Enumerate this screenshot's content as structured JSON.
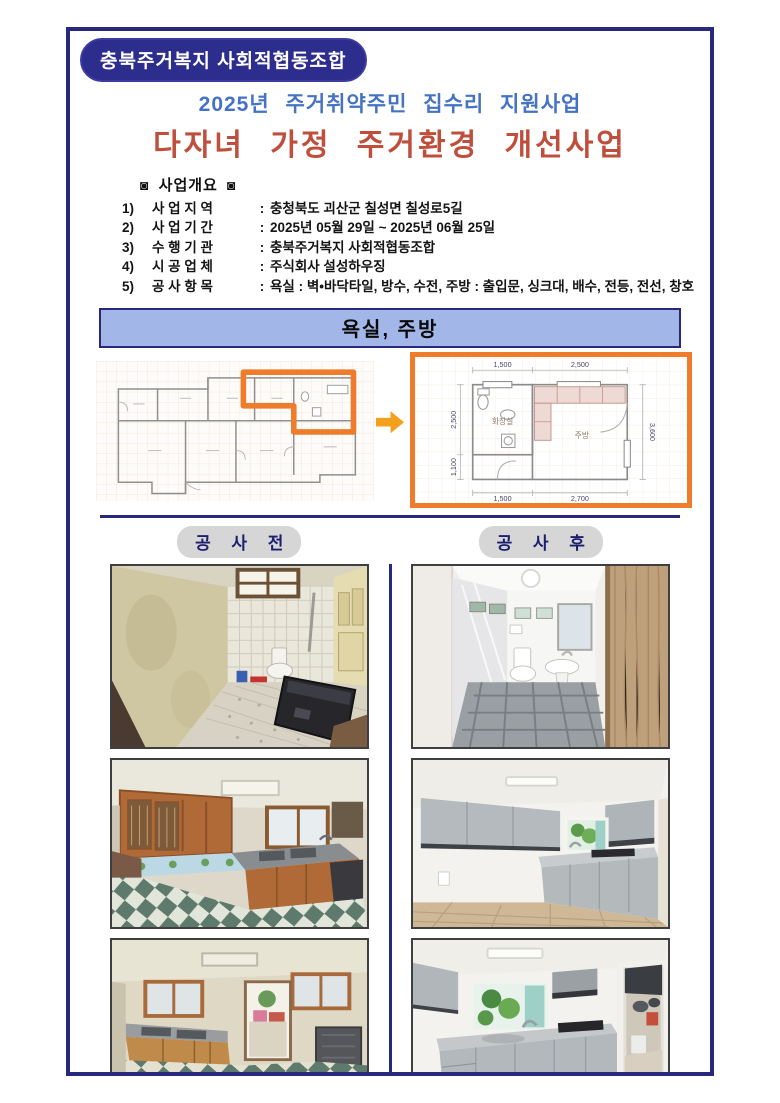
{
  "header": {
    "org_badge": "충북주거복지 사회적협동조합",
    "subtitle": "2025년 주거취약주민 집수리 지원사업",
    "title": "다자녀 가정 주거환경 개선사업"
  },
  "overview": {
    "symbol": "◙",
    "heading": "사업개요",
    "items": [
      {
        "num": "1)",
        "label": "사 업 지 역",
        "colon": ":",
        "value": "충청북도 괴산군 칠성면 칠성로5길"
      },
      {
        "num": "2)",
        "label": "사 업 기 간",
        "colon": ":",
        "value": "2025년 05월 29일 ~ 2025년 06월 25일"
      },
      {
        "num": "3)",
        "label": "수 행 기 관",
        "colon": ":",
        "value": "충북주거복지 사회적협동조합"
      },
      {
        "num": "4)",
        "label": "시 공 업 체",
        "colon": ":",
        "value": "주식회사 설성하우징"
      },
      {
        "num": "5)",
        "label": "공 사 항 목",
        "colon": ":",
        "value": "욕실 : 벽•바닥타일, 방수, 수전,  주방 : 출입문, 싱크대, 배수, 전등, 전선, 창호"
      }
    ]
  },
  "banner": {
    "label": "욕실, 주방"
  },
  "floorplan": {
    "detail": {
      "room_bathroom": "화장실",
      "room_kitchen": "주방",
      "dims": {
        "top_left": "1,500",
        "top_right": "2,500",
        "bottom_left": "1,500",
        "bottom_right": "2,700",
        "left_upper": "2,500",
        "left_lower": "1,100",
        "right": "3,600"
      }
    }
  },
  "photos": {
    "before_label": "공 사 전",
    "after_label": "공 사 후"
  },
  "icons": {
    "arrow_right": "block-right-arrow",
    "overview_bullet": "◙"
  },
  "colors": {
    "frame_navy": "#28287d",
    "badge_navy": "#2d2d8e",
    "title_blue": "#4472c4",
    "title_red": "#bf4f3c",
    "banner_bg": "#a2b6e8",
    "highlight_orange": "#ee7c2a",
    "arrow_orange": "#f5a01d",
    "pill_gray": "#d6d6d6"
  }
}
